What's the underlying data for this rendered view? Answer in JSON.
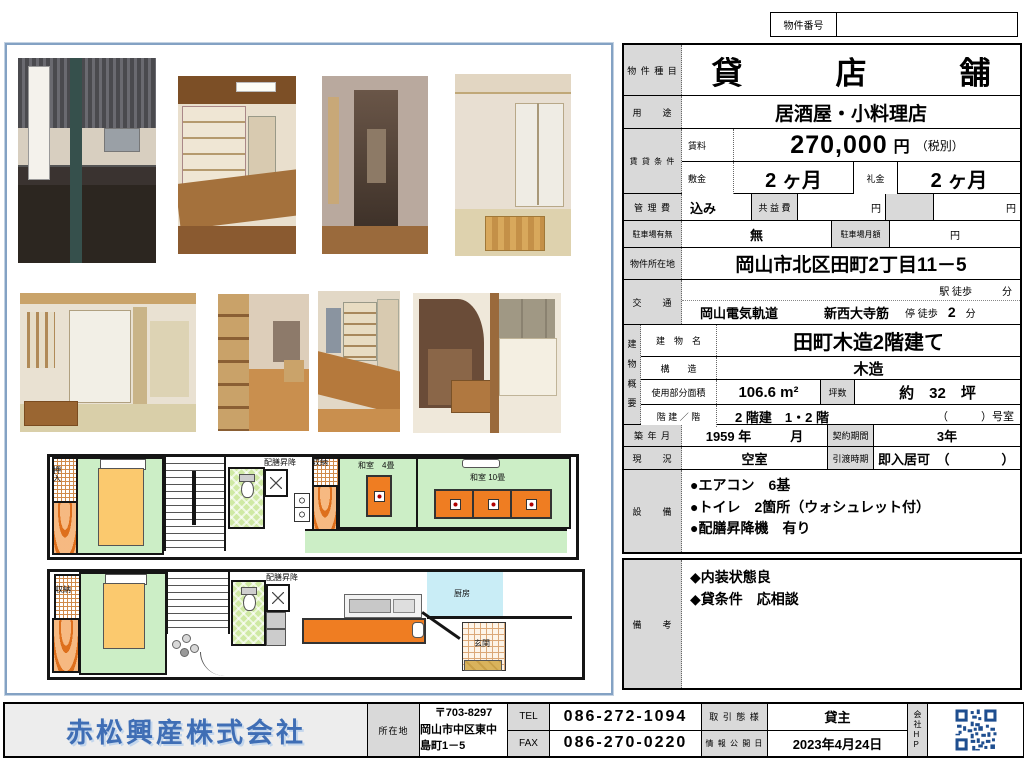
{
  "header": {
    "property_no_label": "物件番号",
    "property_no_value": ""
  },
  "table": {
    "type_label": "物 件 種 目",
    "type_value": "貸　　　店　　　舗",
    "usage_label": "用　　途",
    "usage_value": "居酒屋・小料理店",
    "lease_label": "賃 貸 条 件",
    "rent_label": "賃料",
    "rent_value": "270,000",
    "rent_unit": "円",
    "rent_note": "（税別）",
    "deposit_label": "敷金",
    "deposit_value": "2 ヶ月",
    "key_money_label": "礼金",
    "key_money_value": "2 ヶ月",
    "mgmt_label": "管 理 費",
    "mgmt_value": "込み",
    "kyoueki_label": "共 益 費",
    "yen": "円",
    "parking_label": "駐車場有無",
    "parking_value": "無",
    "parking_monthly_label": "駐車場月額",
    "address_label": "物件所在地",
    "address_value": "岡山市北区田町2丁目11－5",
    "traffic_label": "交　　通",
    "traffic_line1": "駅 徒歩　　　分",
    "traffic_company": "岡山電気軌道",
    "traffic_stop": "新西大寺筋",
    "traffic_tail": "停 徒歩",
    "traffic_min": "2",
    "traffic_unit": "分",
    "building_label": "建\n物\n概\n要",
    "bname_label": "建　物　名",
    "bname_value": "田町木造2階建て",
    "structure_label": "構　　造",
    "structure_value": "木造",
    "area_label": "使用部分面積",
    "area_value": "106.6 m²",
    "tsubo_label": "坪数",
    "tsubo_value": "約　32　坪",
    "floors_label": "階 建 ／ 階",
    "floors_value": "2 階建　1・2 階",
    "floors_room": "（　　　）号室",
    "built_label": "築 年 月",
    "built_value": "1959 年　　　月",
    "contract_label": "契約期間",
    "contract_value": "3年",
    "status_label": "現　　況",
    "status_value": "空室",
    "handover_label": "引渡時期",
    "handover_value": "即入居可　（　　　　）",
    "equipment_label": "設　　備",
    "equipment_items": [
      "●エアコン　6基",
      "●トイレ　2箇所（ウォシュレット付）",
      "●配膳昇降機　有り"
    ],
    "remarks_label": "備　　考",
    "remarks_items": [
      "◆内装状態良",
      "◆貸条件　応相談"
    ]
  },
  "floorplan": {
    "oshiire": "押入",
    "haizen_upper": "配膳昇降",
    "shuno_upper": "収納",
    "washitsu4": "和室　4畳",
    "washitsu10": "和室 10畳",
    "shuno_lower": "収納",
    "haizen_lower": "配膳昇降",
    "kitchen": "厨房",
    "genkan": "玄関"
  },
  "footer": {
    "company": "赤松興産株式会社",
    "address_label": "所在地",
    "postal": "〒703-8297",
    "address": "岡山市中区東中島町1－5",
    "tel_label": "TEL",
    "tel": "086-272-1094",
    "fax_label": "FAX",
    "fax": "086-270-0220",
    "deal_label": "取 引 態 様",
    "deal_value": "貸主",
    "date_label": "情 報 公 開 日",
    "date_value": "2023年4月24日",
    "hp_label": "会\n社\nH\nP"
  }
}
